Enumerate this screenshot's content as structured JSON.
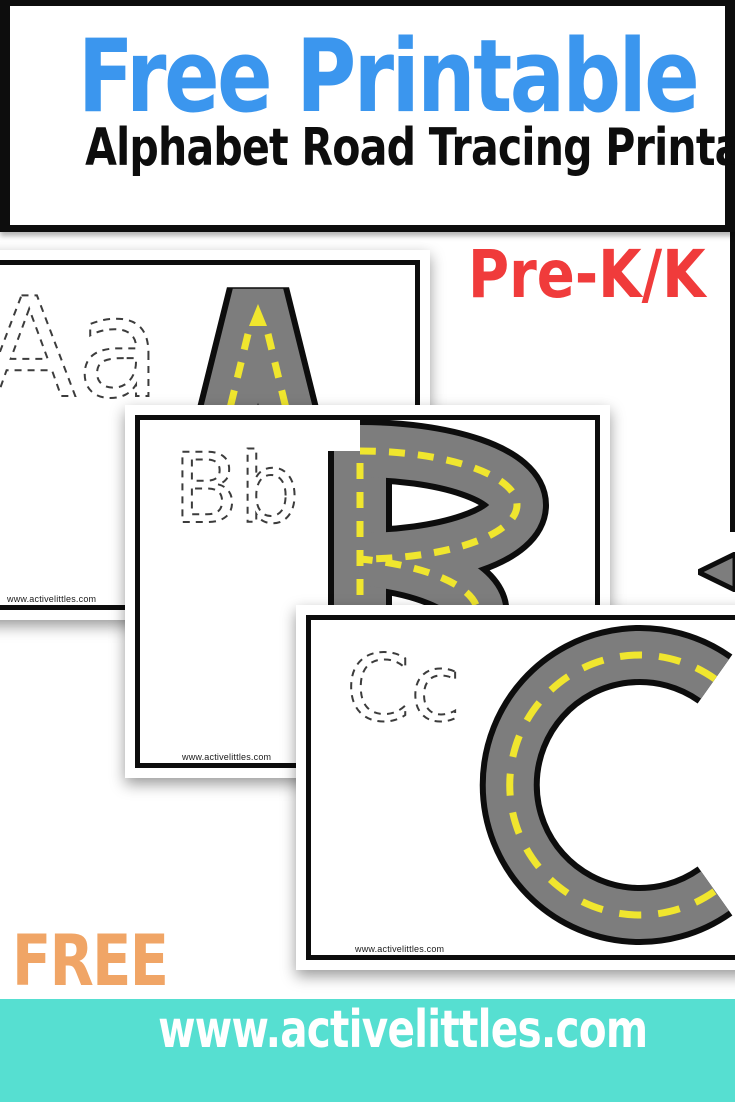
{
  "header": {
    "title": "Free Printable",
    "subtitle": "Alphabet Road Tracing Printable"
  },
  "grade_badge": "Pre-K/K",
  "promo_label": "FREE",
  "footer_banner": {
    "url": "www.activelittles.com"
  },
  "cards": [
    {
      "trace_label": "Aa",
      "road_letter": "A",
      "watermark": "www.activelittles.com"
    },
    {
      "trace_label": "Bb",
      "road_letter": "B",
      "watermark": "www.activelittles.com"
    },
    {
      "trace_label": "Cc",
      "road_letter": "C",
      "watermark": "www.activelittles.com"
    }
  ],
  "colors": {
    "title_blue": "#3B96EE",
    "badge_red": "#F03B3B",
    "free_orange": "#F0A566",
    "banner_teal": "#56DFD1",
    "banner_text": "#FFFFFF",
    "road_gray": "#7D7D7D",
    "road_outline": "#0D0D0D",
    "road_centerline_yellow": "#F0E62E",
    "card_border": "#0D0D0D",
    "frame_black": "#0D0D0D",
    "trace_dash_gray": "#3C3C3C"
  }
}
